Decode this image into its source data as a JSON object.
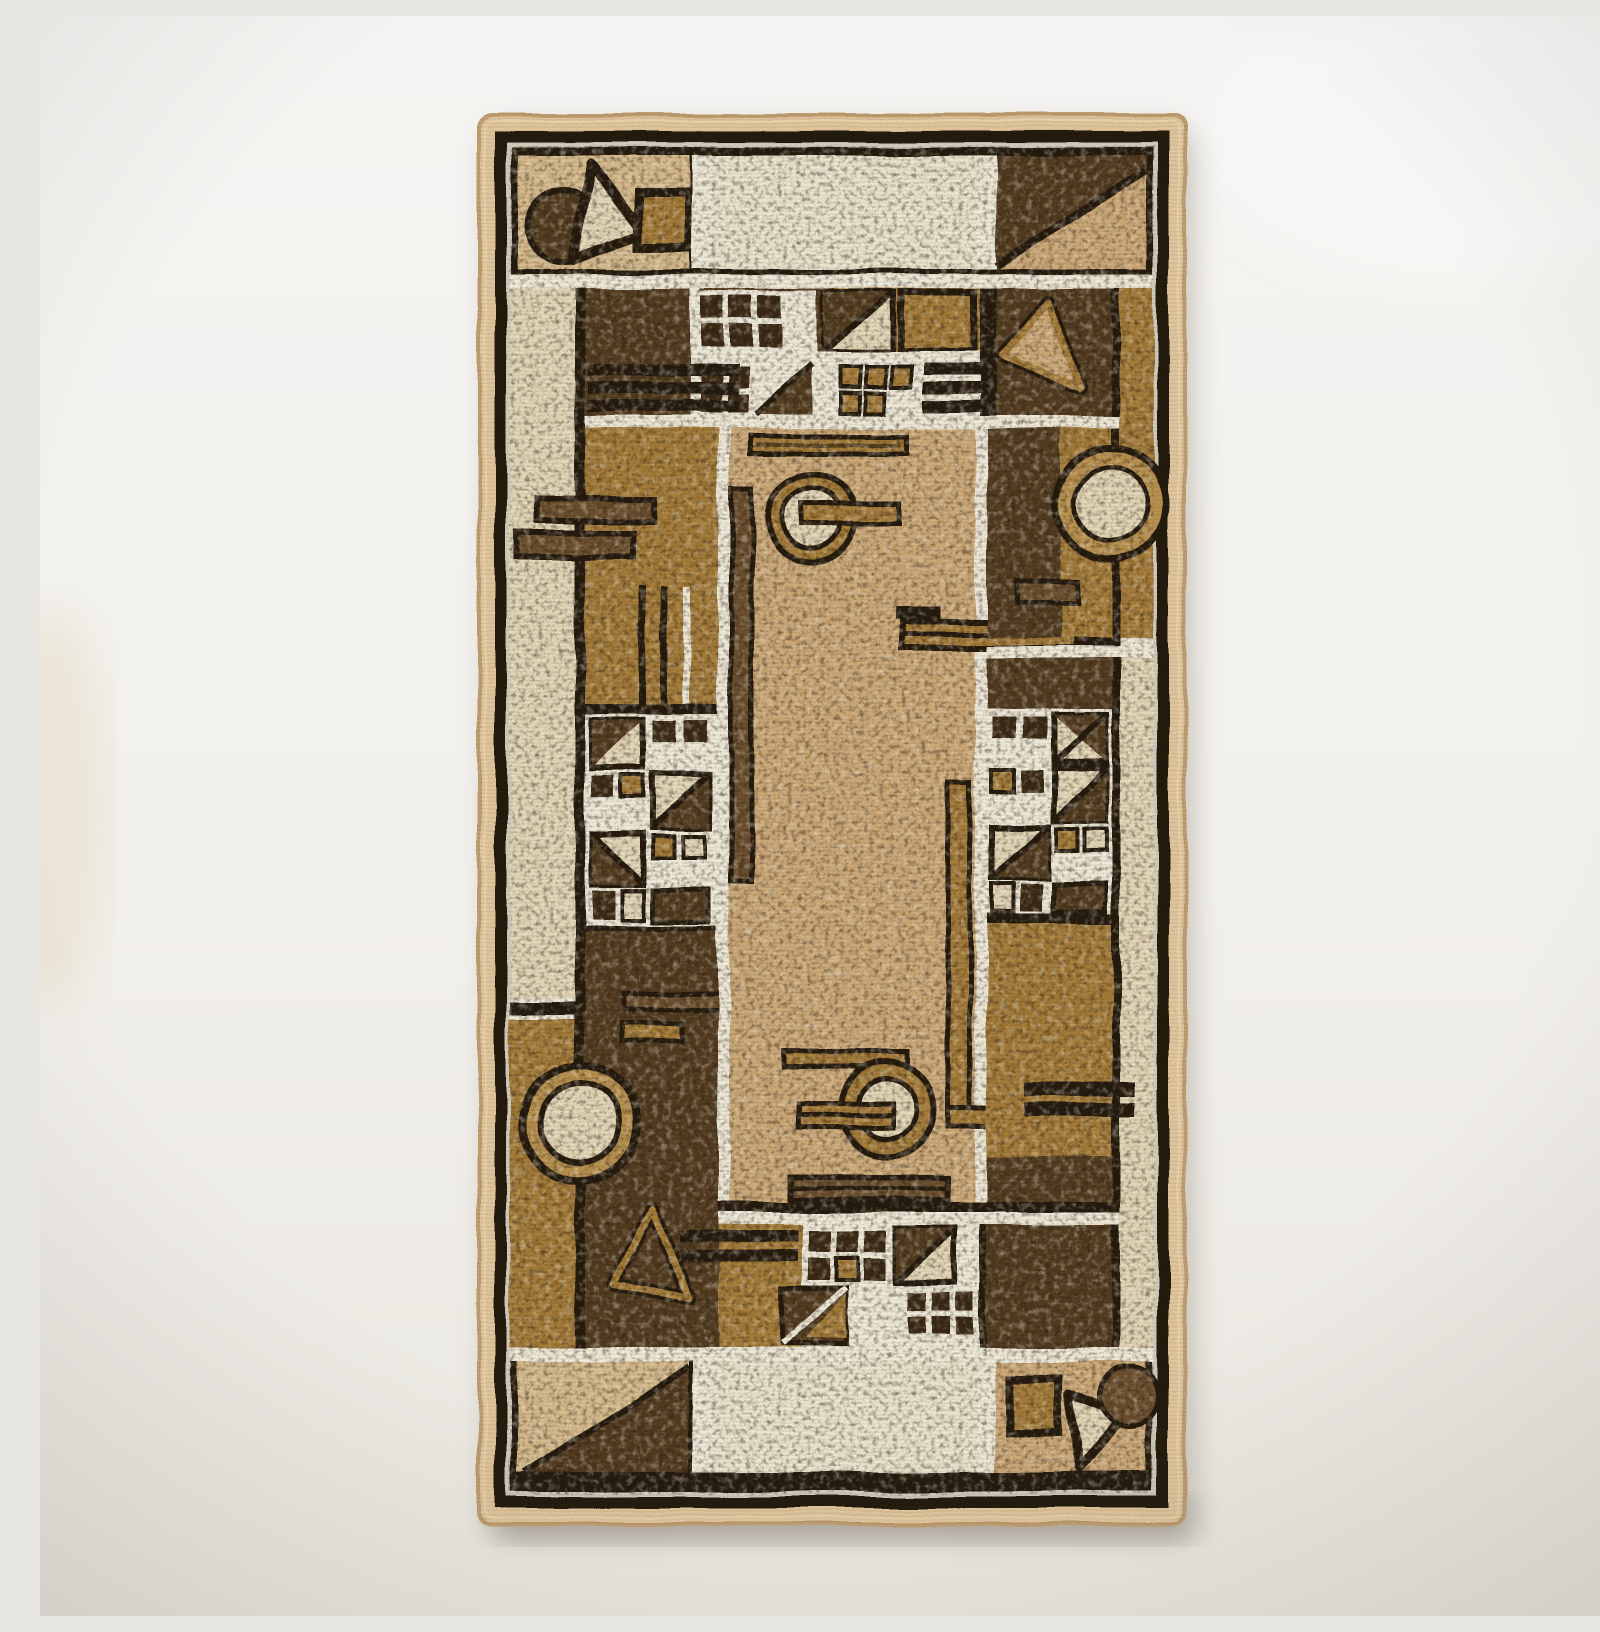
{
  "scene": {
    "type": "product photograph",
    "description": "Top-down photo of a vertical rectangular machine-woven rug with a brown, beige and ochre geometric Bauhaus-style pattern, edged with a plain beige serged binding, lying on an off-white surface with a soft shadow",
    "background": "plain off-white wall / floor surface",
    "object": "rug"
  },
  "rug": {
    "orientation": "vertical rectangle",
    "border": "plain beige overlock binding",
    "style": "geometric color-block grid separated by thin white lines",
    "texture": "speckled mottled woven pile",
    "motifs": [
      "top-left emblem: dark circle, triangle outline and ochre square",
      "top-right panel split by black diagonal into dark brown and beige",
      "band of small dark squares on white grid with diagonal split squares",
      "concentric circle with bar through it (top and bottom of center field)",
      "ochre ring on dark ground (right side)",
      "light circle in double ring on dark ground (bottom left)",
      "ochre triangle outlines",
      "double horizontal bars and long vertical bars",
      "grid clusters of small squares with diagonal triangles (left and right)",
      "bottom-left panel with dark diagonal triangle",
      "bottom-right emblem: ochre square, dark disc and triangle outline"
    ]
  },
  "palette": {
    "wall": "#f3f1ee",
    "wall_shade": "#e4e0d8",
    "rug_shadow": "#968e80",
    "binding": "#e3c89e",
    "binding_shadow": "#c3a072",
    "outline_black": "#251b0f",
    "brown_dark": "#543d22",
    "brown_deep": "#3c2b16",
    "brown_mid": "#6d5130",
    "ochre": "#a67d3a",
    "ochre_light": "#bb9350",
    "beige": "#cfab79",
    "beige_light": "#d9bd8f",
    "cream": "#e7dabb",
    "cream_bright": "#efe7d2",
    "white_line": "#f2eddd"
  }
}
